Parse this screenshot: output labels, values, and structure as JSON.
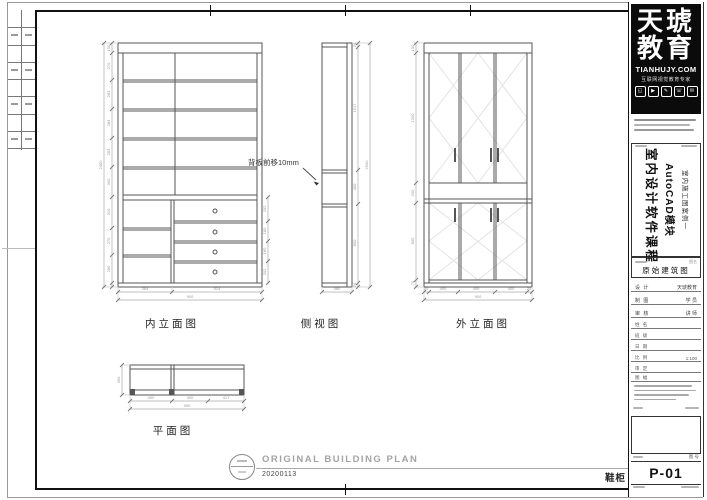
{
  "views": {
    "interior": {
      "label": "内立面图",
      "note": "背板前移10mm",
      "dims_left": [
        "100",
        "270",
        "283",
        "283",
        "283",
        "300",
        "310",
        "270",
        "280"
      ],
      "dim_total_left": "2400",
      "dims_right": [
        "202",
        "180",
        "180",
        "202"
      ],
      "dims_bottom": [
        "364",
        "514"
      ],
      "dim_total_bottom": "900"
    },
    "side": {
      "label": "侧视图",
      "dims_right": [
        "20",
        "1517",
        "400",
        "800",
        "20"
      ],
      "dim_total_right": "2500",
      "dim_bottom": "460"
    },
    "exterior": {
      "label": "外立面图",
      "dims_left": [
        "100",
        "1300",
        "200",
        "800",
        "70"
      ],
      "dims_bottom": [
        "20",
        "400",
        "400",
        "400",
        "20"
      ],
      "dim_total_bottom": "900"
    },
    "plan": {
      "label": "平面图",
      "dim_left": "350",
      "dims_bottom": [
        "400",
        "400",
        "417"
      ],
      "dim_total_bottom": "900"
    }
  },
  "footer": {
    "title_en": "ORIGINAL BUILDING PLAN",
    "date": "20200113",
    "item": "鞋柜"
  },
  "title_block": {
    "logo": {
      "brand_top": "天琥",
      "brand_bottom": "教育",
      "website": "TIANHUJY.COM",
      "slogan": "互联网视觉教育专家"
    },
    "course": {
      "line_main": "室内设计软件课程",
      "line_module": "AutoCAD模块",
      "line_case": "室内施工图案例一"
    },
    "drawing_name_label": "图名",
    "drawing_name": "原始建筑图",
    "fields": [
      {
        "label": "设 计",
        "value": "天琥教育"
      },
      {
        "label": "制 图",
        "value": "学 员"
      },
      {
        "label": "审 核",
        "value": "讲 师"
      }
    ],
    "sub_fields": [
      {
        "label": "姓 名",
        "value": ""
      },
      {
        "label": "班 级",
        "value": ""
      },
      {
        "label": "日 期",
        "value": ""
      },
      {
        "label": "比 例",
        "value": "1:100"
      },
      {
        "label": "审 定",
        "value": ""
      },
      {
        "label": "图 幅",
        "value": ""
      }
    ],
    "sheet_no_label": "图 号",
    "sheet_no": "P-01"
  }
}
